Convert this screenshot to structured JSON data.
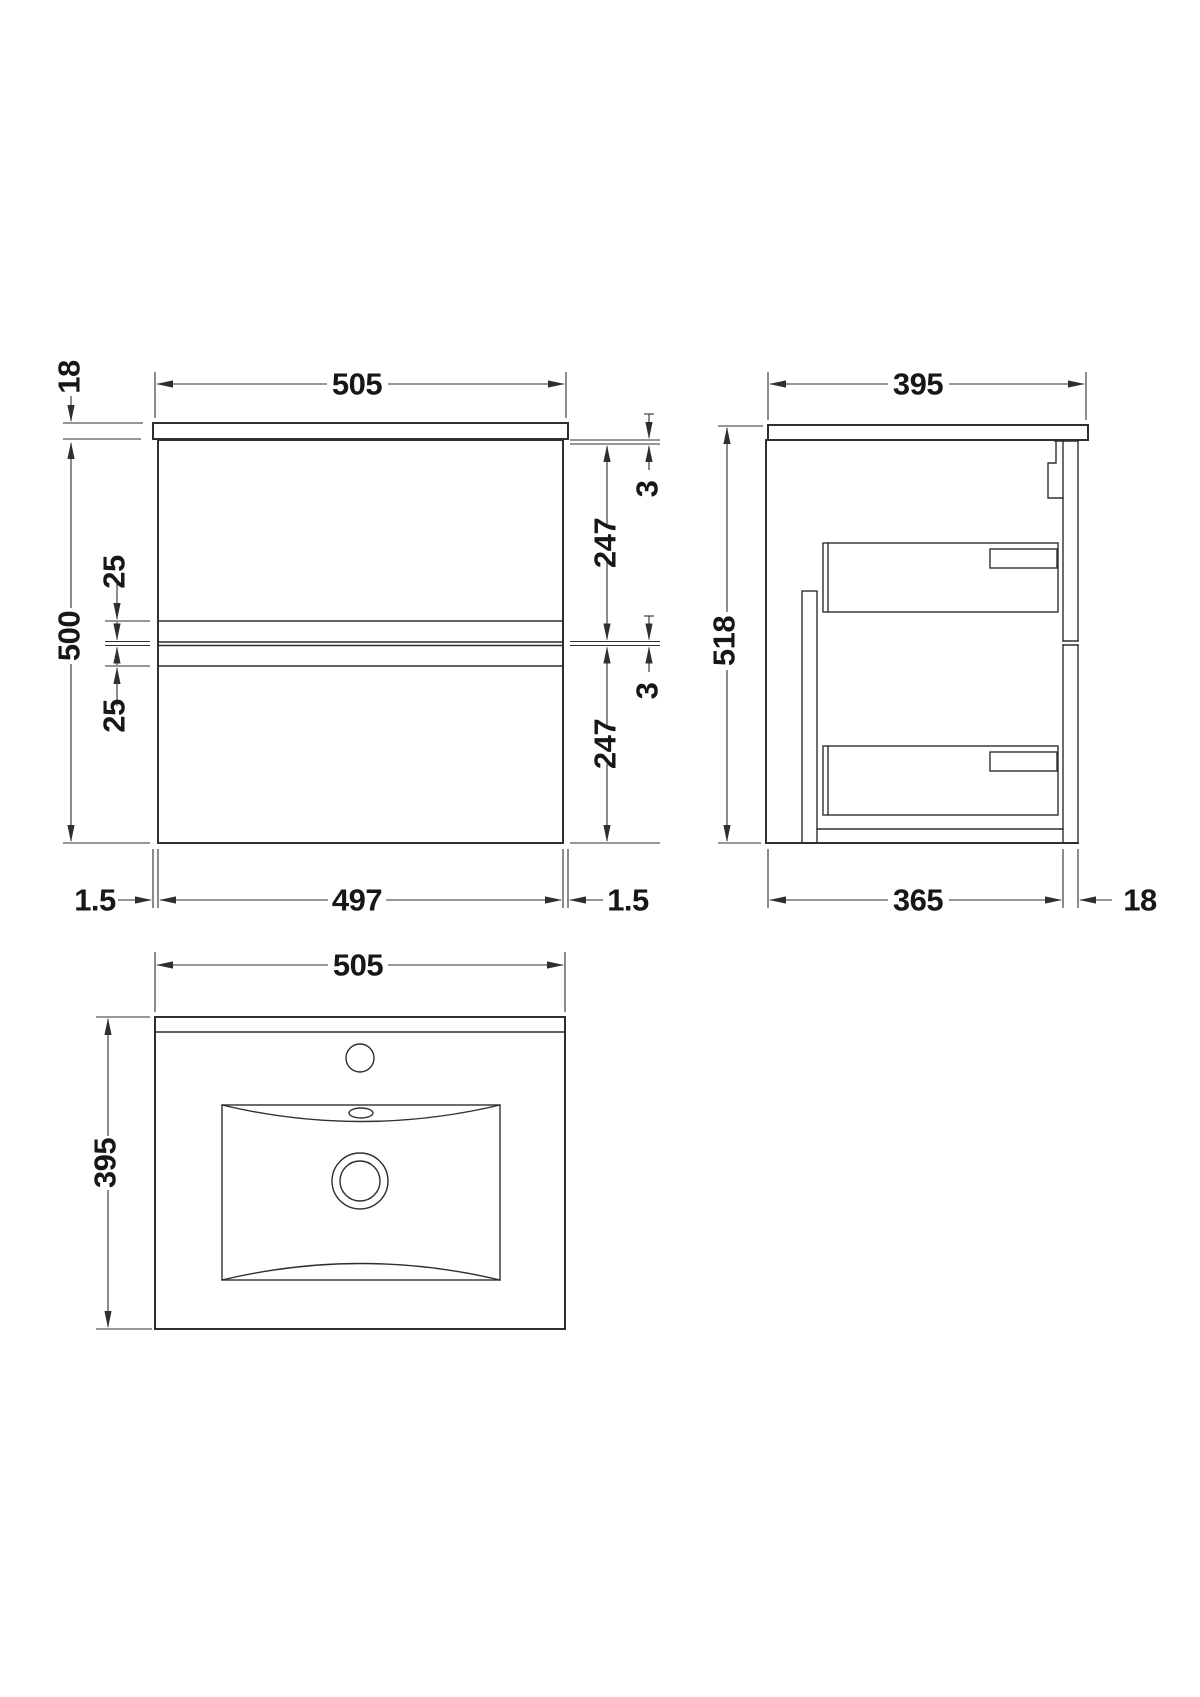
{
  "colors": {
    "line": "#2f2f2f",
    "text": "#171717",
    "background": "#ffffff"
  },
  "front_view": {
    "width_top": "505",
    "worktop_thickness": "18",
    "cabinet_height": "500",
    "groove_upper": "25",
    "groove_lower": "25",
    "gap_top": "3",
    "drawer_upper": "247",
    "gap_middle": "3",
    "drawer_lower": "247",
    "overhang_left": "1.5",
    "carcass_width": "497",
    "overhang_right": "1.5"
  },
  "side_view": {
    "depth": "395",
    "overall_height": "518",
    "internal_depth": "365",
    "front_panel_thickness": "18"
  },
  "plan_view": {
    "basin_width": "505",
    "basin_depth": "395"
  }
}
